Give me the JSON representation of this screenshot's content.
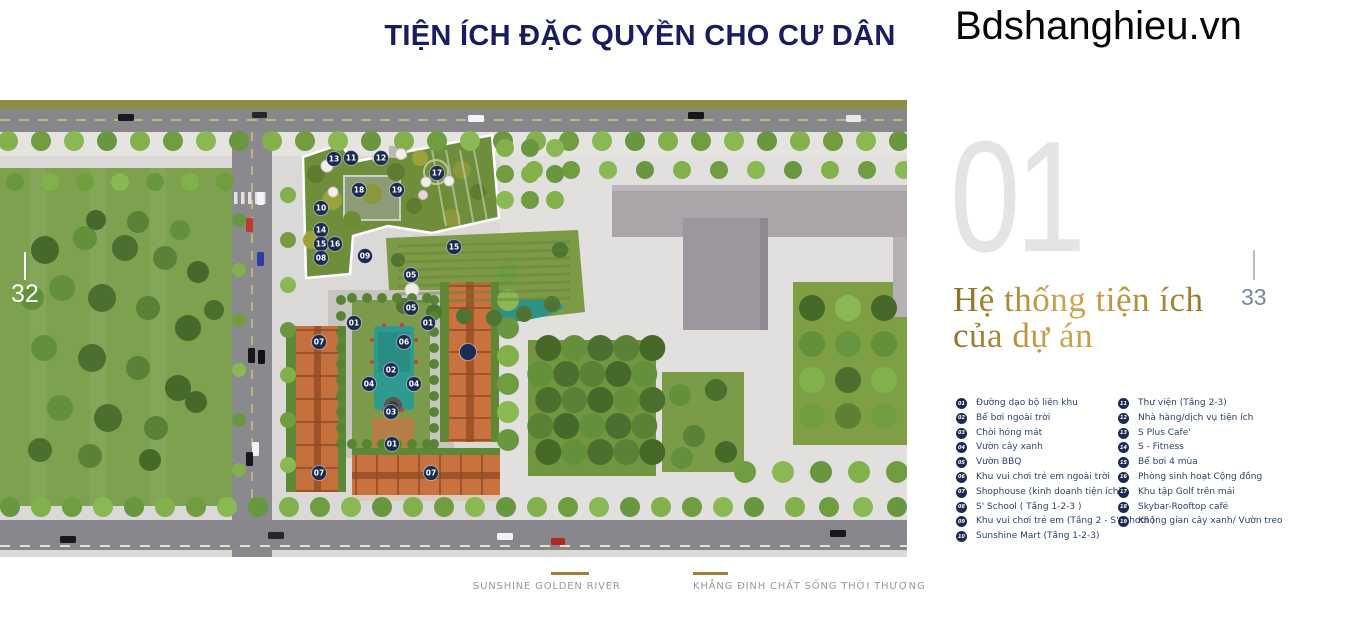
{
  "watermark": "Bdshanghieu.vn",
  "header": {
    "title": "TIỆN ÍCH ĐẶC QUYỀN CHO CƯ DÂN"
  },
  "section": {
    "number": "01",
    "heading_line1": "Hệ thống tiện ích",
    "heading_line2": "của dự án"
  },
  "page_numbers": {
    "left": "32",
    "right": "33"
  },
  "legend": {
    "col1": [
      {
        "num": "01",
        "label": "Đường dạo bộ liên khu"
      },
      {
        "num": "02",
        "label": "Bể bơi ngoài trời"
      },
      {
        "num": "03",
        "label": "Chòi hóng mát"
      },
      {
        "num": "04",
        "label": "Vườn cây xanh"
      },
      {
        "num": "05",
        "label": "Vườn BBQ"
      },
      {
        "num": "06",
        "label": "Khu vui chơi trẻ em ngoài trời"
      },
      {
        "num": "07",
        "label": "Shophouse (kinh doanh tiện ích)"
      },
      {
        "num": "08",
        "label": "S' School ( Tầng 1-2-3 )"
      },
      {
        "num": "09",
        "label": "Khu vui chơi trẻ em (Tầng 2 - S'School )"
      },
      {
        "num": "10",
        "label": "Sunshine Mart (Tầng 1-2-3)"
      }
    ],
    "col2": [
      {
        "num": "11",
        "label": "Thư viện (Tầng 2-3)"
      },
      {
        "num": "12",
        "label": "Nhà hàng/dịch vụ tiện ích"
      },
      {
        "num": "13",
        "label": "S Plus Cafe'"
      },
      {
        "num": "14",
        "label": "S - Fitness"
      },
      {
        "num": "15",
        "label": "Bể bơi 4 mùa"
      },
      {
        "num": "16",
        "label": "Phòng sinh hoạt Cộng đồng"
      },
      {
        "num": "17",
        "label": "Khu tập Golf trên mái"
      },
      {
        "num": "18",
        "label": "Skybar-Rooftop café"
      },
      {
        "num": "19",
        "label": "Không gian cây xanh/ Vườn treo"
      }
    ]
  },
  "map": {
    "markers": [
      {
        "label": "13",
        "x": 334,
        "y": 59
      },
      {
        "label": "11",
        "x": 351,
        "y": 58
      },
      {
        "label": "12",
        "x": 381,
        "y": 58
      },
      {
        "label": "17",
        "x": 437,
        "y": 73
      },
      {
        "label": "18",
        "x": 359,
        "y": 90
      },
      {
        "label": "19",
        "x": 397,
        "y": 90
      },
      {
        "label": "10",
        "x": 321,
        "y": 108
      },
      {
        "label": "14",
        "x": 321,
        "y": 130
      },
      {
        "label": "15",
        "x": 321,
        "y": 144
      },
      {
        "label": "16",
        "x": 335,
        "y": 144
      },
      {
        "label": "08",
        "x": 321,
        "y": 158
      },
      {
        "label": "09",
        "x": 365,
        "y": 156
      },
      {
        "label": "05",
        "x": 411,
        "y": 175
      },
      {
        "label": "15",
        "x": 454,
        "y": 147
      },
      {
        "label": "05",
        "x": 411,
        "y": 208
      },
      {
        "label": "01",
        "x": 354,
        "y": 223
      },
      {
        "label": "01",
        "x": 428,
        "y": 223
      },
      {
        "label": "07",
        "x": 319,
        "y": 242
      },
      {
        "label": "06",
        "x": 404,
        "y": 242
      },
      {
        "label": "02",
        "x": 391,
        "y": 270
      },
      {
        "label": "04",
        "x": 369,
        "y": 284
      },
      {
        "label": "04",
        "x": 414,
        "y": 284
      },
      {
        "label": "03",
        "x": 391,
        "y": 312
      },
      {
        "label": "01",
        "x": 392,
        "y": 344
      },
      {
        "label": "07",
        "x": 319,
        "y": 373
      },
      {
        "label": "07",
        "x": 431,
        "y": 373
      },
      {
        "label": "",
        "x": 468,
        "y": 252
      }
    ]
  },
  "footer": {
    "brand": "SUNSHINE GOLDEN RIVER",
    "slogan": "KHẲNG ĐỊNH CHẤT SỐNG THỜI THƯỢNG"
  },
  "colors": {
    "title_navy": "#191d5f",
    "accent_gold": "#a37d2b",
    "marker_navy": "#1b2b52",
    "legend_text": "#2d3f70",
    "big_number_gray": "#e4e4e6"
  }
}
